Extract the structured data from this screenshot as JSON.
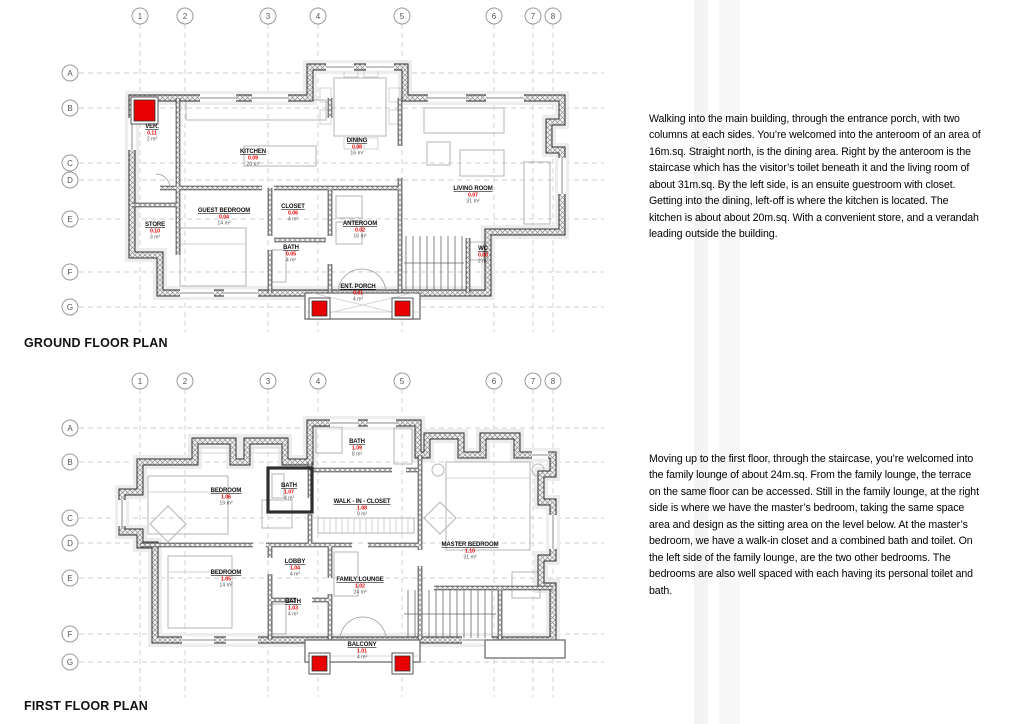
{
  "colors": {
    "accent_red": "#e80000",
    "wall": "#2e2e2e",
    "text": "#111111"
  },
  "descriptions": [
    "Walking into the main building, through the entrance porch, with two columns at each sides. You’re welcomed into the anteroom of an area of 16m.sq. Straight north, is the dining area. Right by the anteroom is the staircase which has the visitor’s toilet beneath it and the living room of about 31m.sq. By the left side, is an ensuite guestroom with closet. Getting into the dining, left-off is where the kitchen is located. The kitchen is about about 20m.sq. With a convenient store, and a verandah leading outside the building.",
    "Moving up to the first floor, through the staircase, you’re welcomed into the family lounge of about 24m.sq. From the family lounge, the terrace on the same floor can be accessed. Still in the family lounge, at the right side is where we have the master’s bedroom, taking the same space area and design as the sitting area on the level below. At the master’s bedroom, we have a walk-in closet and a combined bath and toilet. On the left side of the family lounge, are the two other bedrooms. The bedrooms are also well spaced with each having its personal toilet and bath."
  ],
  "plans": [
    {
      "id": "ground",
      "title": "GROUND FLOOR PLAN",
      "grid": {
        "bubble_y": 16,
        "line_top": 24,
        "line_bottom": 332,
        "bubble_x": 70,
        "line_left": 79,
        "line_right": 604,
        "cols": [
          {
            "label": "1",
            "x": 140
          },
          {
            "label": "2",
            "x": 185
          },
          {
            "label": "3",
            "x": 268
          },
          {
            "label": "4",
            "x": 318
          },
          {
            "label": "5",
            "x": 402
          },
          {
            "label": "6",
            "x": 494
          },
          {
            "label": "7",
            "x": 533
          },
          {
            "label": "8",
            "x": 553
          }
        ],
        "rows": [
          {
            "label": "A",
            "y": 73
          },
          {
            "label": "B",
            "y": 108
          },
          {
            "label": "C",
            "y": 163
          },
          {
            "label": "D",
            "y": 180
          },
          {
            "label": "E",
            "y": 219
          },
          {
            "label": "F",
            "y": 272
          },
          {
            "label": "G",
            "y": 307
          }
        ]
      },
      "rooms": [
        {
          "name": "VER.",
          "code": "0.11",
          "area": "2 m²",
          "x": 152,
          "y": 128
        },
        {
          "name": "STORE",
          "code": "0.10",
          "area": "3 m²",
          "x": 155,
          "y": 226
        },
        {
          "name": "KITCHEN",
          "code": "0.09",
          "area": "20 m²",
          "x": 253,
          "y": 153
        },
        {
          "name": "DINING",
          "code": "0.08",
          "area": "16 m²",
          "x": 357,
          "y": 142
        },
        {
          "name": "LIVING ROOM",
          "code": "0.07",
          "area": "31 m²",
          "x": 473,
          "y": 190
        },
        {
          "name": "GUEST BEDROOM",
          "code": "0.04",
          "area": "14 m²",
          "x": 224,
          "y": 212
        },
        {
          "name": "CLOSET",
          "code": "0.06",
          "area": "4 m²",
          "x": 293,
          "y": 208
        },
        {
          "name": "BATH",
          "code": "0.05",
          "area": "4 m²",
          "x": 291,
          "y": 249
        },
        {
          "name": "ANTEROOM",
          "code": "0.02",
          "area": "16 m²",
          "x": 360,
          "y": 225
        },
        {
          "name": "WC",
          "code": "0.03",
          "area": "2 m²",
          "x": 483,
          "y": 250
        },
        {
          "name": "ENT. PORCH",
          "code": "0.01",
          "area": "4 m²",
          "x": 358,
          "y": 288
        }
      ],
      "columns": [
        {
          "x": 134,
          "y": 100,
          "s": 21
        },
        {
          "x": 312,
          "y": 301,
          "s": 15
        },
        {
          "x": 395,
          "y": 301,
          "s": 15
        }
      ]
    },
    {
      "id": "first",
      "title": "FIRST FLOOR PLAN",
      "grid": {
        "bubble_y": 381,
        "line_top": 389,
        "line_bottom": 697,
        "bubble_x": 70,
        "line_left": 79,
        "line_right": 604,
        "cols": [
          {
            "label": "1",
            "x": 140
          },
          {
            "label": "2",
            "x": 185
          },
          {
            "label": "3",
            "x": 268
          },
          {
            "label": "4",
            "x": 318
          },
          {
            "label": "5",
            "x": 402
          },
          {
            "label": "6",
            "x": 494
          },
          {
            "label": "7",
            "x": 533
          },
          {
            "label": "8",
            "x": 553
          }
        ],
        "rows": [
          {
            "label": "A",
            "y": 428
          },
          {
            "label": "B",
            "y": 462
          },
          {
            "label": "C",
            "y": 518
          },
          {
            "label": "D",
            "y": 543
          },
          {
            "label": "E",
            "y": 578
          },
          {
            "label": "F",
            "y": 634
          },
          {
            "label": "G",
            "y": 662
          }
        ]
      },
      "rooms": [
        {
          "name": "BATH",
          "code": "1.09",
          "area": "8 m²",
          "x": 357,
          "y": 443
        },
        {
          "name": "BEDROOM",
          "code": "1.06",
          "area": "19 m²",
          "x": 226,
          "y": 492
        },
        {
          "name": "BATH",
          "code": "1.07",
          "area": "4 m²",
          "x": 289,
          "y": 487
        },
        {
          "name": "WALK - IN - CLOSET",
          "code": "1.08",
          "area": "9 m²",
          "x": 362,
          "y": 503
        },
        {
          "name": "LOBBY",
          "code": "1.04",
          "area": "4 m²",
          "x": 295,
          "y": 563
        },
        {
          "name": "BEDROOM",
          "code": "1.05",
          "area": "14 m²",
          "x": 226,
          "y": 574
        },
        {
          "name": "FAMILY LOUNGE",
          "code": "1.02",
          "area": "24 m²",
          "x": 360,
          "y": 581
        },
        {
          "name": "BATH",
          "code": "1.03",
          "area": "4 m²",
          "x": 293,
          "y": 603
        },
        {
          "name": "MASTER BEDROOM",
          "code": "1.10",
          "area": "31 m²",
          "x": 470,
          "y": 546
        },
        {
          "name": "BALCONY",
          "code": "1.01",
          "area": "4 m²",
          "x": 362,
          "y": 646
        }
      ],
      "columns": [
        {
          "x": 312,
          "y": 656,
          "s": 15
        },
        {
          "x": 395,
          "y": 656,
          "s": 15
        }
      ]
    }
  ]
}
